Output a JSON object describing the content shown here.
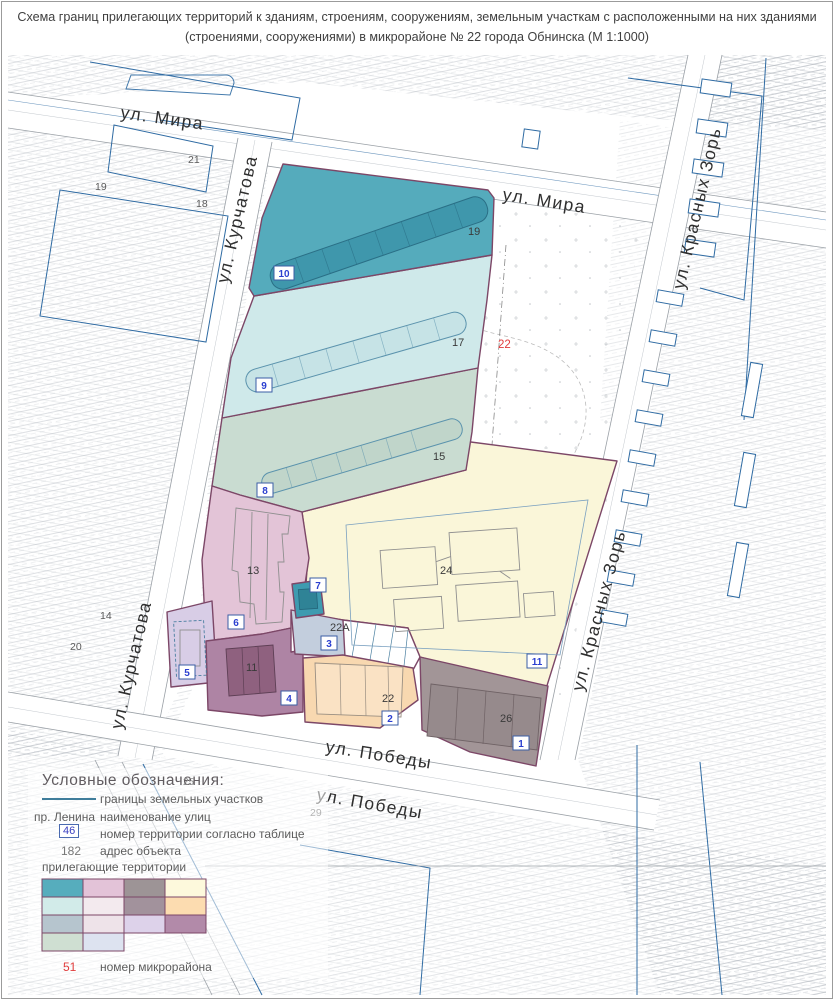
{
  "title": {
    "line1": "Схема границ прилегающих территорий к зданиям, строениям, сооружениям, земельным участкам с расположенными на них зданиями",
    "line2": "(строениями, сооружениями) в микрорайоне № 22 города Обнинска (М 1:1000)"
  },
  "map": {
    "streets": {
      "mira1": "ул. Мира",
      "mira2": "ул. Мира",
      "kurchatova1": "ул. Курчатова",
      "kurchatova2": "ул. Курчатова",
      "krasnykh1": "ул. Красных Зорь",
      "krasnykh2": "ул. Красных Зорь",
      "pobedy1": "ул. Победы",
      "pobedy2": "ул. Победы"
    },
    "badges": {
      "t1": "1",
      "t2": "2",
      "t3": "3",
      "t4": "4",
      "t5": "5",
      "t6": "6",
      "t7": "7",
      "t8": "8",
      "t9": "9",
      "t10": "10",
      "t11": "11"
    },
    "buildings": {
      "b19": "19",
      "b17": "17",
      "b15": "15",
      "b13": "13",
      "b24": "24",
      "b22a": "22А",
      "b22": "22",
      "b26": "26",
      "b11": "11"
    },
    "background_numbers": {
      "n14": "14",
      "n18": "18",
      "n19": "19",
      "n20": "20",
      "n21": "21",
      "n29": "29"
    },
    "microdistrict": "22"
  },
  "legend": {
    "title": "Условные обозначения:",
    "bg_number": "25",
    "line_label": "границы земельных участков",
    "street_key": "пр. Ленина",
    "street_label": "наименование улиц",
    "territory_key": "46",
    "territory_label": "номер территории согласно таблице",
    "address_key": "182",
    "address_label": "адрес объекта",
    "adjacent_title": "прилегающие территории",
    "swatch_colors": [
      "#56adbd",
      "#e3c3d8",
      "#9d9496",
      "#fdf9dc",
      "#d2ebe9",
      "#f3eaee",
      "#a2929c",
      "#fcdcb0",
      "#b6c5ce",
      "#eee3e9",
      "#ddd2ea",
      "#b28aa9",
      "#cfdfd2",
      "#dde3f0"
    ],
    "micro_key": "51",
    "micro_label": "номер микрорайона"
  },
  "colors": {
    "boundary": "#7c4767",
    "parcel_blue": "#2f6ba3",
    "zone_teal": "#55abbc",
    "strip19": "#3f97ac",
    "zone_cyan": "#cfe9ea",
    "strip17": "#c6e3e6",
    "zone_green": "#c9dcd1",
    "strip15": "#c0d5ca",
    "zone_pink": "#e3c4d7",
    "zone_lavender": "#d8cde6",
    "zone_mauve": "#ae84a4",
    "bld11": "#8f617f",
    "zone_bluegray": "#c3cedd",
    "zone_peach": "#f8d8b0",
    "zone_gray": "#a29597",
    "bld26": "#968a8c",
    "zone_yellow": "#faf6d9",
    "zone_teal_small": "#3e9bb0",
    "badge_text": "#2b3fd0",
    "micro_red": "#e03c3c"
  }
}
